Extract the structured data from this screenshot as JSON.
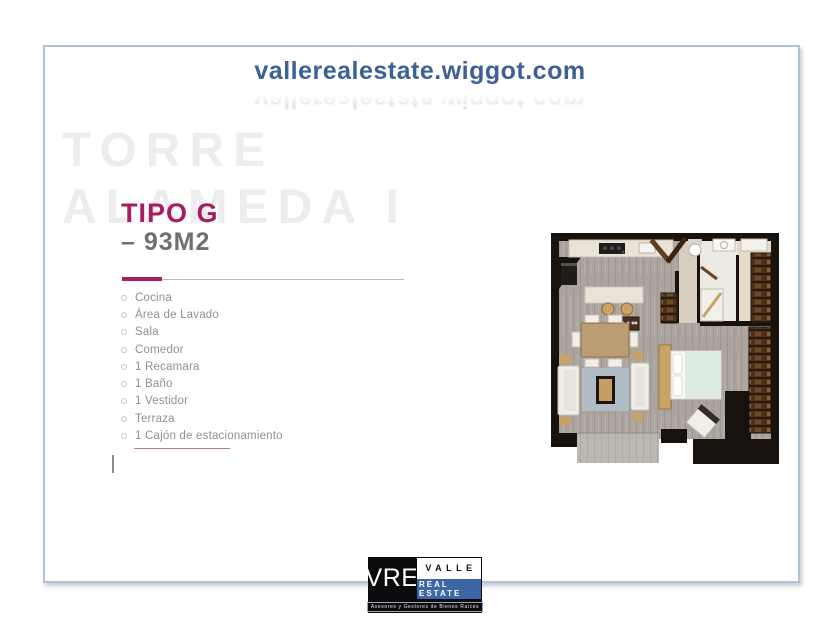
{
  "header": {
    "url": "vallerealestate.wiggot.com",
    "color": "#3d6095"
  },
  "watermark": {
    "line1": "TORRE",
    "line2": "ALAMEDA I",
    "color": "#ededed"
  },
  "unit": {
    "title": "TIPO G",
    "subtitle": "– 93M2",
    "accent_color": "#a81d61",
    "features": [
      "Cocina",
      "Área de Lavado",
      "Sala",
      "Comedor",
      "1 Recamara",
      "1 Baño",
      "1 Vestidor",
      "Terraza",
      "1 Cajón de estacionamiento"
    ]
  },
  "floorplan": {
    "label": "Planta arquitectónica Tipo G 93 m2"
  },
  "logo": {
    "monogram": "VRE",
    "name_top": "VALLE",
    "name_bottom": "REAL ESTATE",
    "tagline": "Asesores y Gestores de Bienes Raices",
    "blue": "#3c66a4"
  },
  "frame": {
    "border_color": "#aec4d6"
  }
}
